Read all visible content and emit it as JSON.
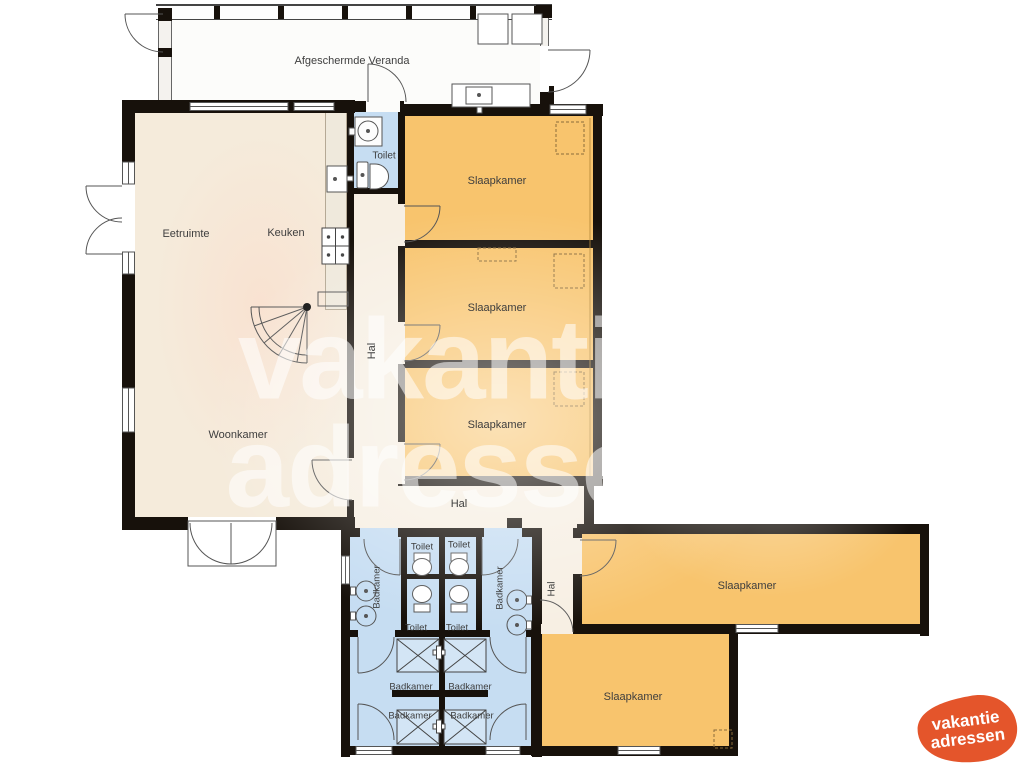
{
  "labels": {
    "veranda": "Afgeschermde Veranda",
    "dining": "Eetruimte",
    "kitchen": "Keuken",
    "living": "Woonkamer",
    "hall": "Hal",
    "toilet": "Toilet",
    "bedroom": "Slaapkamer",
    "bathroom": "Badkamer"
  },
  "watermark": {
    "line1": "vakantie",
    "line2": "adressen"
  },
  "logo": {
    "line1": "vakantie",
    "line2": "adressen"
  },
  "colors": {
    "wall": "#17110b",
    "bedroom_fill": "#f8c46d",
    "bathroom_fill": "#c6ddf2",
    "living_fill": "#f5ebdb",
    "hall_fill": "#f7efe3",
    "veranda_fill": "#fcfcfa",
    "logo_orange": "#e4552b"
  }
}
